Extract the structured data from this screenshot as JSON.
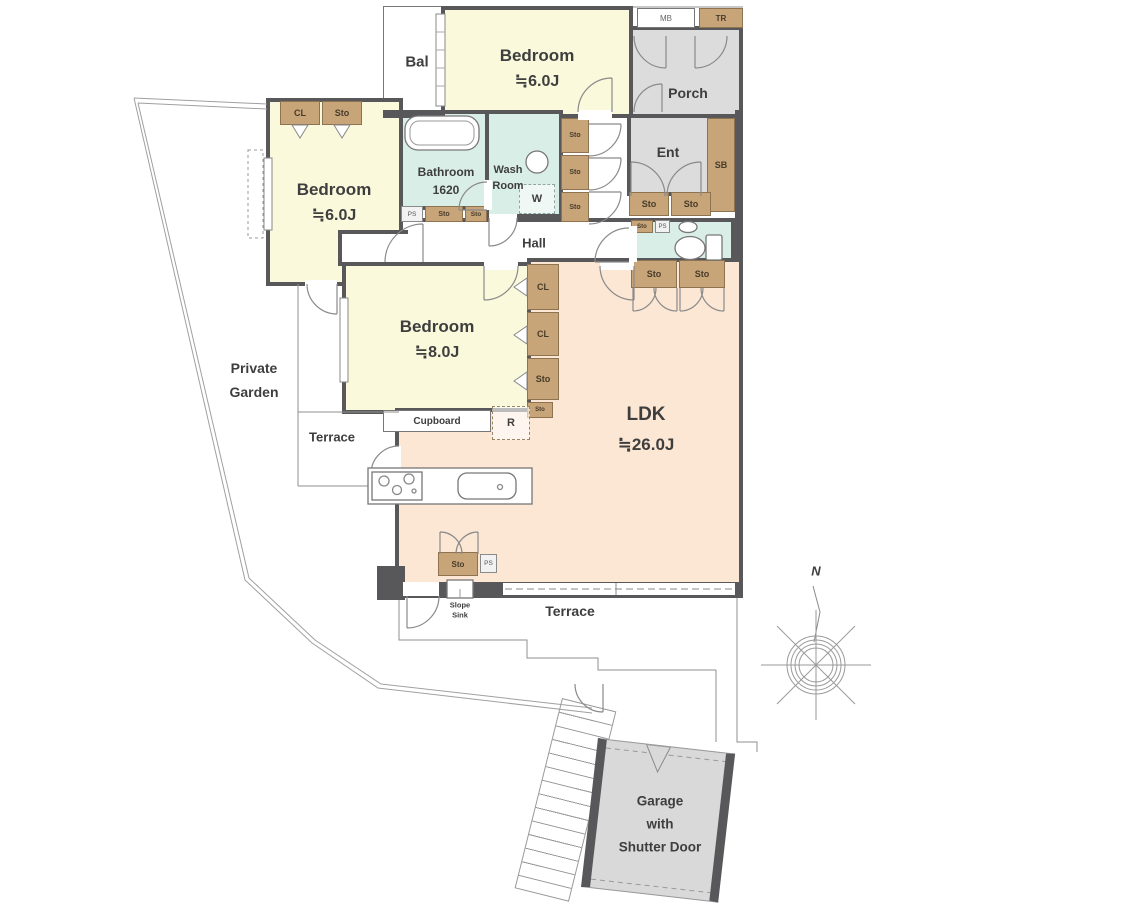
{
  "rooms": {
    "bal": "Bal",
    "bedroom_top": {
      "name": "Bedroom",
      "size": "≒6.0J"
    },
    "porch": "Porch",
    "bedroom_left": {
      "name": "Bedroom",
      "size": "≒6.0J"
    },
    "bathroom": {
      "name": "Bathroom",
      "size": "1620"
    },
    "washroom": {
      "line1": "Wash",
      "line2": "Room"
    },
    "ent": "Ent",
    "hall": "Hall",
    "bedroom_mid": {
      "name": "Bedroom",
      "size": "≒8.0J"
    },
    "ldk": {
      "name": "LDK",
      "size": "≒26.0J"
    },
    "garden": {
      "line1": "Private",
      "line2": "Garden"
    },
    "terrace_upper": "Terrace",
    "terrace_lower": "Terrace",
    "garage": {
      "line1": "Garage",
      "line2": "with",
      "line3": "Shutter Door"
    }
  },
  "tags": {
    "mb": "MB",
    "tr": "TR",
    "sb": "SB",
    "cl": "CL",
    "sto": "Sto",
    "ps": "PS",
    "w": "W",
    "r": "R",
    "cupboard": "Cupboard",
    "slope_sink_line1": "Slope",
    "slope_sink_line2": "Sink"
  },
  "compass": {
    "north": "N"
  },
  "colors": {
    "wall": "#58585b",
    "tatami_room": "#fbf9dc",
    "ldk_room": "#fbe7d4",
    "wet_room": "#daeee8",
    "service_gray": "#dcdcdc",
    "closet_tan": "#c8a479",
    "outline": "#8a8a8a",
    "text": "#3e3e3e"
  }
}
